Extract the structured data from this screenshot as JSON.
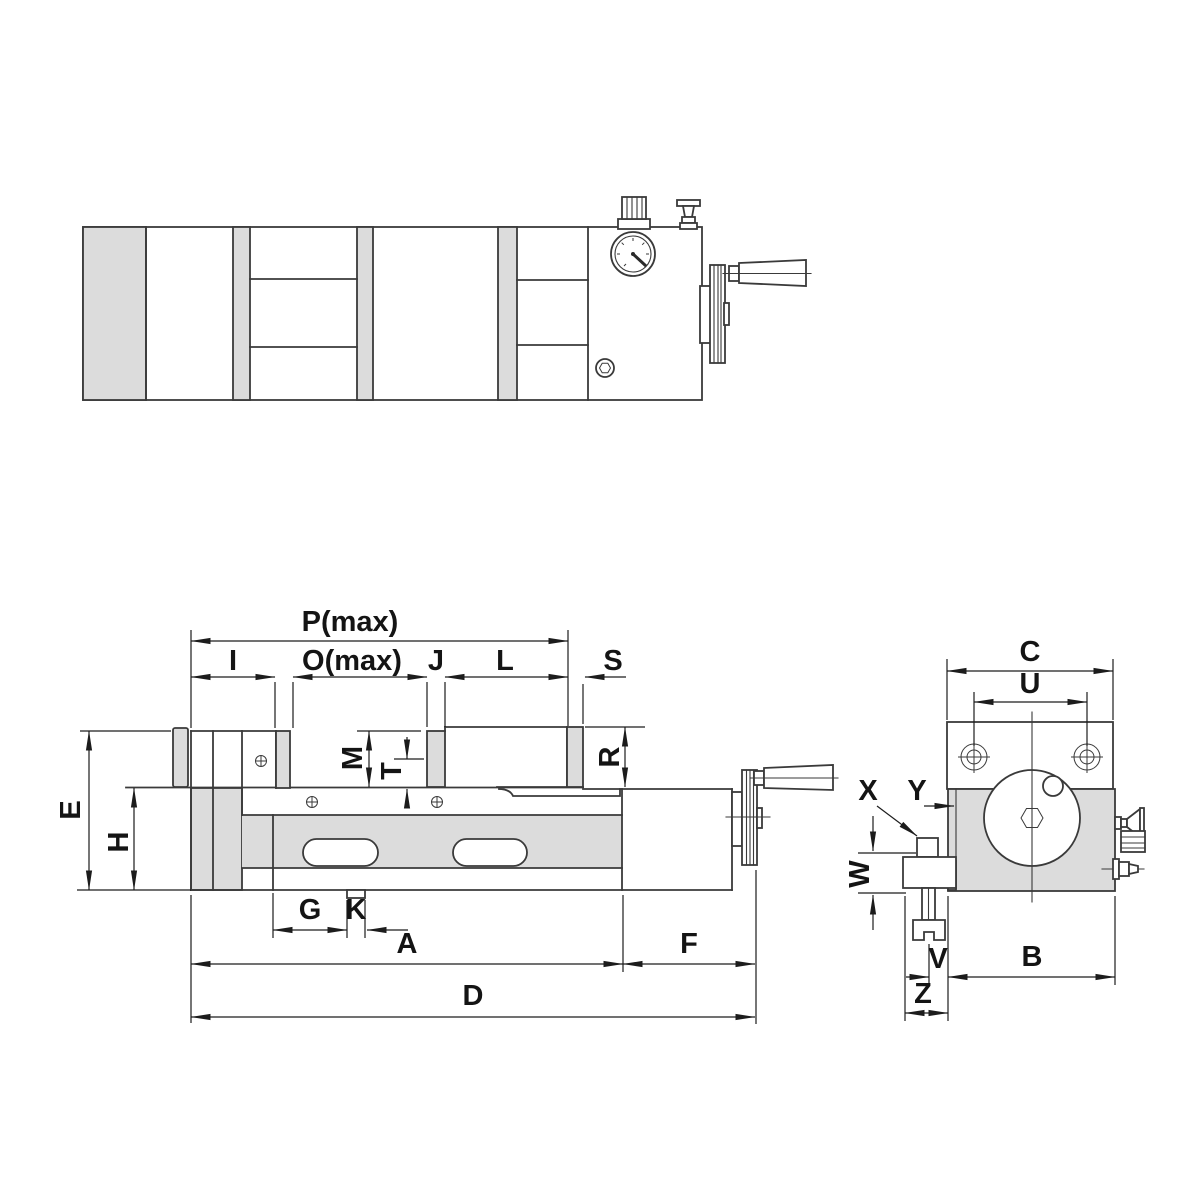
{
  "labels": {
    "p_max": "P(max)",
    "i": "I",
    "o_max": "O(max)",
    "j": "J",
    "l": "L",
    "s": "S",
    "m": "M",
    "t": "T",
    "r": "R",
    "e": "E",
    "h": "H",
    "g": "G",
    "k": "K",
    "a": "A",
    "f": "F",
    "d": "D",
    "c": "C",
    "u": "U",
    "x": "X",
    "y": "Y",
    "w": "W",
    "v": "V",
    "b": "B",
    "z": "Z"
  },
  "colors": {
    "line": "#3a3a3a",
    "dimension": "#1c1c1c",
    "text": "#141414",
    "fill_grey": "#dcdcdc",
    "background": "#ffffff"
  }
}
